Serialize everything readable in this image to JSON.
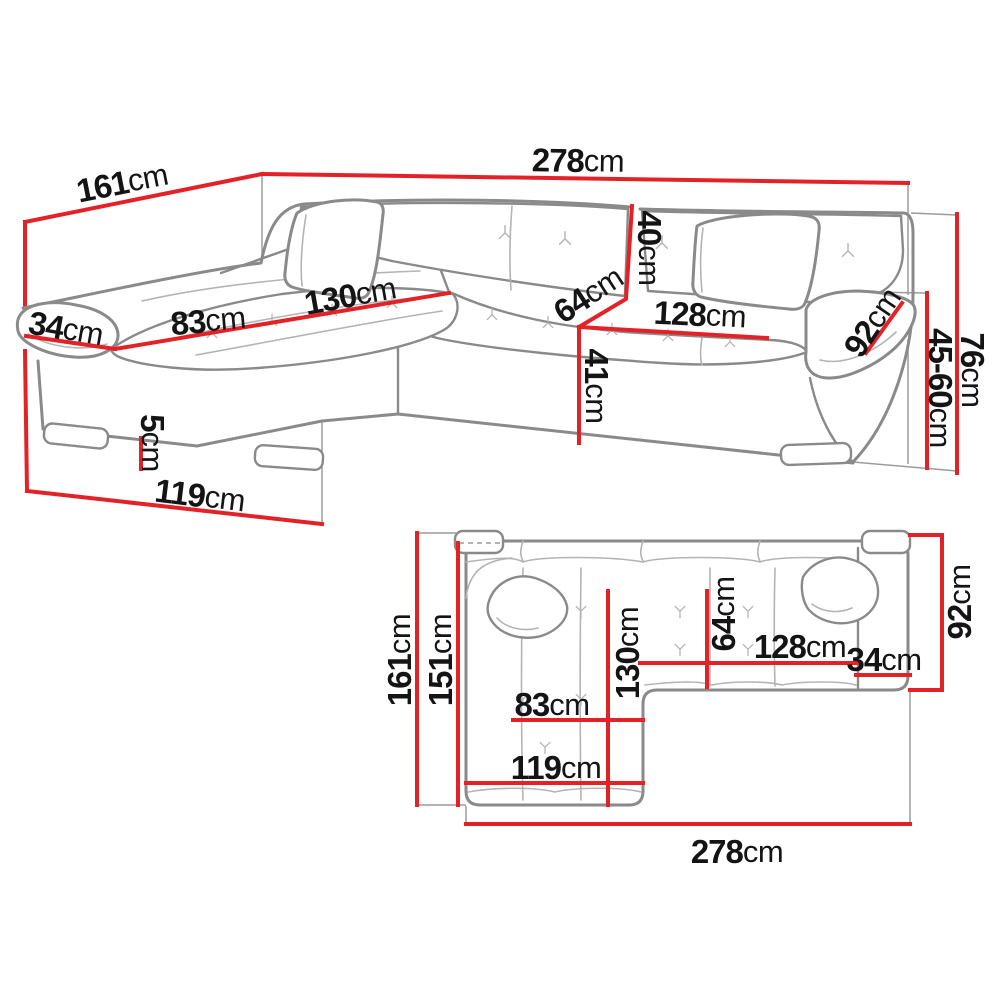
{
  "page": {
    "title": "corner-sofa-dimensions-diagram",
    "background": "#ffffff"
  },
  "colors": {
    "dimension_line": "#e32228",
    "sofa_outline": "#8a8a8a",
    "seam_line": "#b4b4b4",
    "construction_line": "#9c9c9c",
    "label_text": "#141414"
  },
  "perspective_view": {
    "dims": [
      {
        "id": "depth-total",
        "value": "161",
        "unit": "cm"
      },
      {
        "id": "width-total",
        "value": "278",
        "unit": "cm"
      },
      {
        "id": "armrest-left-width",
        "value": "34",
        "unit": "cm"
      },
      {
        "id": "chaise-seat-width",
        "value": "83",
        "unit": "cm"
      },
      {
        "id": "chaise-length",
        "value": "130",
        "unit": "cm"
      },
      {
        "id": "backrest-height",
        "value": "40",
        "unit": "cm"
      },
      {
        "id": "seat-depth",
        "value": "64",
        "unit": "cm"
      },
      {
        "id": "seat-width",
        "value": "128",
        "unit": "cm"
      },
      {
        "id": "armrest-right-length",
        "value": "92",
        "unit": "cm"
      },
      {
        "id": "seat-front-height",
        "value": "41",
        "unit": "cm"
      },
      {
        "id": "armrest-height-range",
        "value": "45-60",
        "unit": "cm"
      },
      {
        "id": "total-height",
        "value": "76",
        "unit": "cm"
      },
      {
        "id": "leg-height",
        "value": "5",
        "unit": "cm"
      },
      {
        "id": "chaise-width",
        "value": "119",
        "unit": "cm"
      }
    ]
  },
  "plan_view": {
    "dims": [
      {
        "id": "depth-total",
        "value": "161",
        "unit": "cm"
      },
      {
        "id": "depth-inner",
        "value": "151",
        "unit": "cm"
      },
      {
        "id": "chaise-length",
        "value": "130",
        "unit": "cm"
      },
      {
        "id": "seat-depth",
        "value": "64",
        "unit": "cm"
      },
      {
        "id": "seat-width",
        "value": "128",
        "unit": "cm"
      },
      {
        "id": "armrest-width",
        "value": "34",
        "unit": "cm"
      },
      {
        "id": "armrest-length",
        "value": "92",
        "unit": "cm"
      },
      {
        "id": "chaise-seat-width",
        "value": "83",
        "unit": "cm"
      },
      {
        "id": "chaise-width",
        "value": "119",
        "unit": "cm"
      },
      {
        "id": "width-total",
        "value": "278",
        "unit": "cm"
      }
    ]
  }
}
